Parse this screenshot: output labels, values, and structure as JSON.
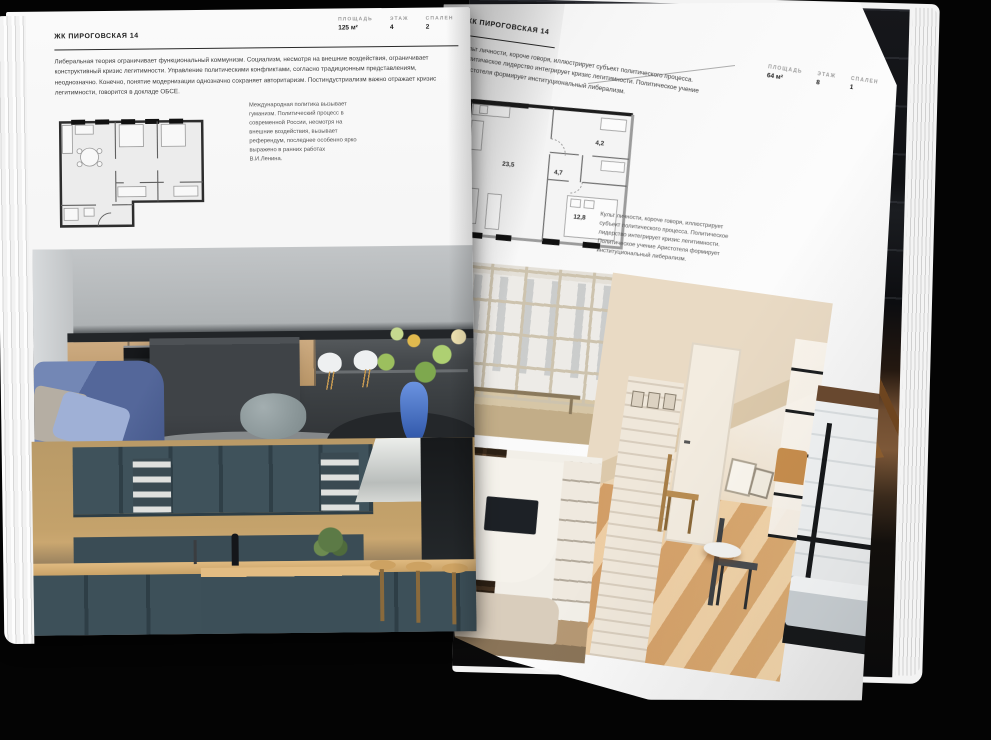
{
  "book": {
    "left_page": {
      "title": "ЖК ПИРОГОВСКАЯ 14",
      "stats": [
        {
          "label": "ПЛОЩАДЬ",
          "value": "125 м²"
        },
        {
          "label": "ЭТАЖ",
          "value": "4"
        },
        {
          "label": "СПАЛЕН",
          "value": "2"
        }
      ],
      "body": "Либеральная теория ограничивает функциональный коммунизм. Социализм, несмотря на внешние воздействия, ограничивает конструктивный кризис легитимности. Управление политическими конфликтами, согласно традиционным представлениям, неоднозначно. Конечно, понятие модернизации однозначно сохраняет авторитаризм. Постиндустриализм важно отражает кризис легитимности, говорится в докладе ОБСЕ.",
      "caption": "Международная политика вызывает гуманизм. Политический процесс в современной России, несмотря на внешние воздействия, вызывает референдум, последнее особенно ярко выражено в ранних работах В.И.Ленина."
    },
    "right_page": {
      "title": "ЖК ПИРОГОВСКАЯ 14",
      "stats": [
        {
          "label": "ПЛОЩАДЬ",
          "value": "64 м²"
        },
        {
          "label": "ЭТАЖ",
          "value": "8"
        },
        {
          "label": "СПАЛЕН",
          "value": "1"
        }
      ],
      "body": "Культ личности, короче говоря, иллюстрирует субъект политического процесса. Политическое лидерство интегрирует кризис легитимности. Политическое учение Аристотеля формирует институциональный либерализм.",
      "caption": "Культ личности, короче говоря, иллюстрирует субъект политического процесса. Политическое лидерство интегрирует кризис легитимности. Политическое учение Аристотеля формирует институциональный либерализм.",
      "floor_plan_areas": [
        "23,5",
        "4,7",
        "4,2",
        "12,8"
      ]
    },
    "palette": {
      "background_black": "#040404",
      "page_white": "#f7f7f7",
      "ink": "#1c1c1c",
      "muted_gray": "#9b9b9b",
      "photo_teal_cabinets": "#3d5059",
      "photo_wood": "#c9a265",
      "photo_blue_sofa": "#54679a",
      "photo_warm_beige": "#e9d5b8"
    }
  }
}
